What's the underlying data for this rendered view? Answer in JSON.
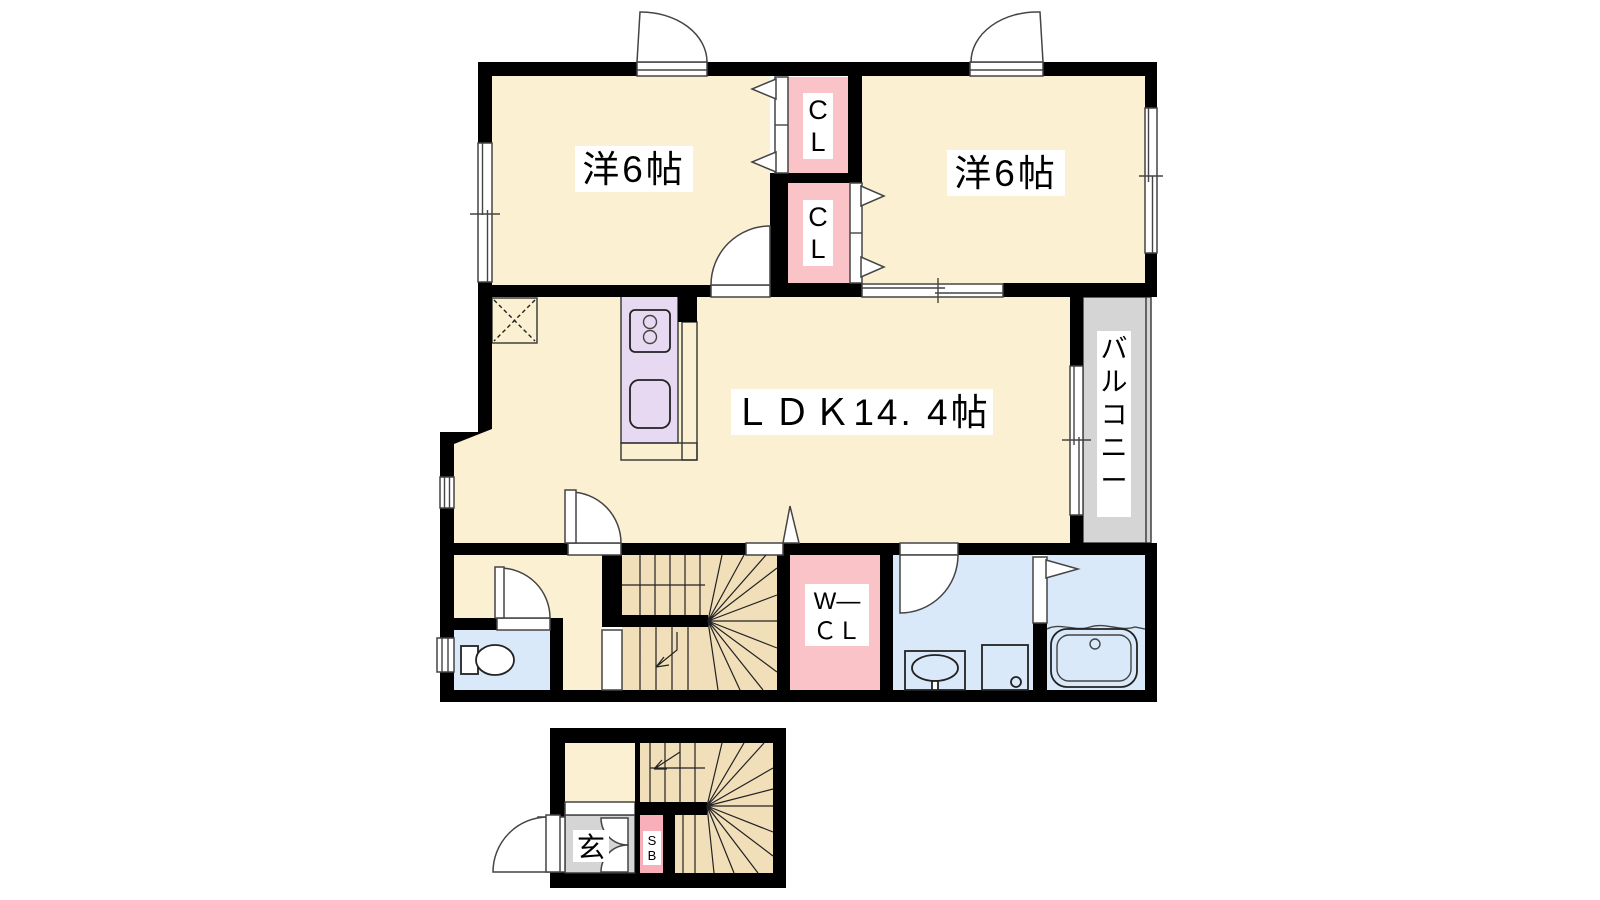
{
  "colors": {
    "wall": "#000000",
    "cream": "#FCF0D2",
    "tan": "#F1DFB9",
    "pink": "#F9C3C8",
    "pinkDeep": "#F8AFB9",
    "lavender": "#E7D9F1",
    "blue": "#D9E9F9",
    "gray": "#D5D5D5",
    "line": "#333333"
  },
  "rooms": {
    "bedroom1": {
      "label": "洋6帖"
    },
    "bedroom2": {
      "label": "洋6帖"
    },
    "ldk": {
      "label": "ＬＤＫ14. 4帖"
    },
    "closet_upper": {
      "line1": "C",
      "line2": "L"
    },
    "closet_lower": {
      "line1": "C",
      "line2": "L"
    },
    "walk_in_closet": {
      "line1": "W―",
      "line2": "ＣＬ"
    },
    "balcony": {
      "chars": [
        "バ",
        "ル",
        "コ",
        "ニ",
        "ー"
      ]
    },
    "entrance": {
      "label": "玄"
    },
    "shoe_box": {
      "line1": "S",
      "line2": "B"
    }
  }
}
